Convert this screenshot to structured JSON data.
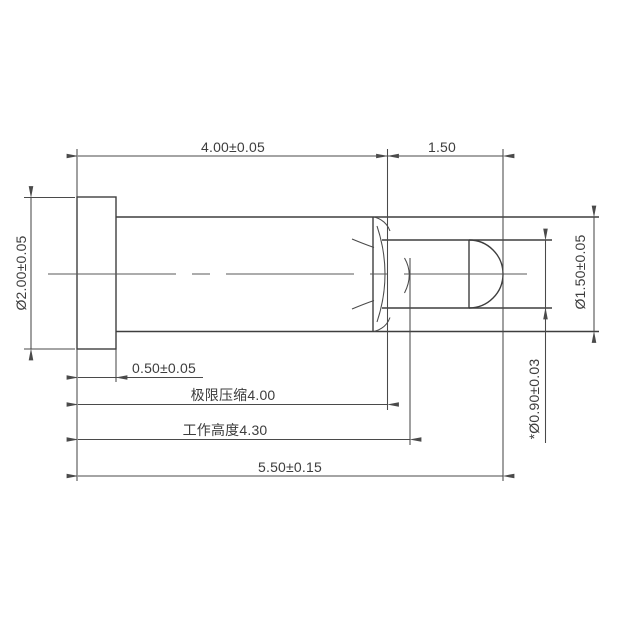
{
  "drawing": {
    "background_color": "#ffffff",
    "line_color": "#4a4a4a",
    "part_line_color": "#3e3e3e",
    "text_color": "#3d3d3d",
    "view": "pogo-pin side profile with flange, barrel, crimped nose and domed plunger"
  },
  "labels": {
    "body_length": "4.00±0.05",
    "plunger_exposed_length": "1.50",
    "flange_diameter": "Ø2.00±0.05",
    "barrel_diameter": "Ø1.50±0.05",
    "plunger_tip_diameter": "*Ø0.90±0.03",
    "flange_thickness": "0.50±0.05",
    "limit_compression": "极限压缩4.00",
    "working_height": "工作高度4.30",
    "overall_length": "5.50±0.15"
  }
}
